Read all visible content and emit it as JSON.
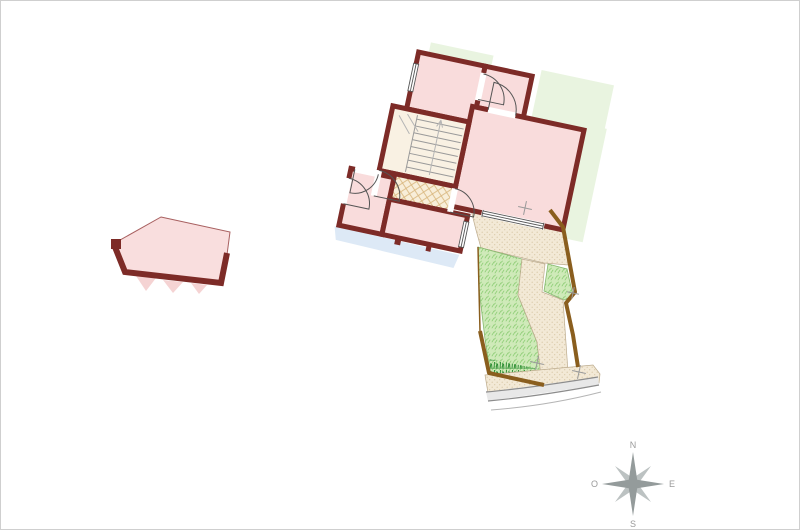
{
  "compass": {
    "north": "N",
    "south": "S",
    "east": "E",
    "west": "O"
  },
  "colors": {
    "wall": "#7d2b27",
    "room": "#f9dcdc",
    "stair_room": "#f9f1e3",
    "tile_bg": "#f8eed9",
    "tile_line": "#d9b77e",
    "grass": "#cfeab9",
    "grass_tick": "#8fce77",
    "tuft": "#2f8f35",
    "paving_bg": "#f3e9d6",
    "paving_dot": "#d6c5a2",
    "site_green": "#e9f4e0",
    "shadow_blue": "#dde9f6",
    "boundary_brown": "#8a5e1e",
    "road_fill": "#e8e8e8",
    "road_line": "#8c8c8c",
    "annex_fill": "#f9dede",
    "annex_outline": "#a86060",
    "compass_gray": "#949b9b",
    "compass_light": "#bcc2c2",
    "marker_gray": "#9a9a9a",
    "border": "#cfcfcf"
  }
}
